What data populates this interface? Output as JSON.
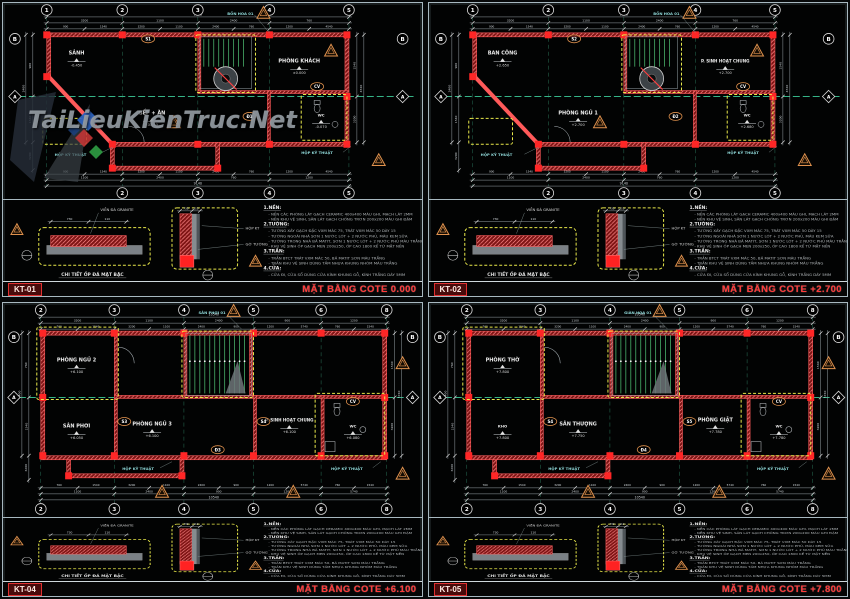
{
  "watermark": {
    "text": "TaiLieuKienTruc.Net"
  },
  "colors": {
    "frame_silver": "#a7b8c0",
    "wall_red_fill": "#7e1414",
    "wall_red_line": "#ff5a5a",
    "column_red": "#ff2626",
    "axis_green": "#35b487",
    "grid_green": "#2e7d62",
    "dim_gray": "#98a2a8",
    "dim_text": "#d5dbdf",
    "highlight_yellow": "#e8e84a",
    "warn_orange": "#e0924e",
    "tag_cyan": "#8fd8d8",
    "title_red": "#ff3a3a",
    "stair_green": "#49b06a",
    "watermark_gray": "#949ca3",
    "logo_dark": "#252c36",
    "logo_dark2": "#3a4147",
    "logo_blue": "#2f66c4",
    "logo_red": "#c23535",
    "logo_green": "#2f9e44",
    "logo_navy": "#1c3f7a"
  },
  "notes": {
    "groups": [
      {
        "head": "1.NỀN:",
        "lines": [
          "- NỀN CÁC PHÒNG LÁT GẠCH CERAMIC 400x400 MÀU GHI, MẠCH LÁT 2MM",
          "- NỀN KHU VỆ SINH, SÂN LÁT GẠCH CHỐNG TRƠN 200x200 MÀU GHI ĐẬM"
        ]
      },
      {
        "head": "2.TƯỜNG:",
        "lines": [
          "- TƯỜNG XÂY GẠCH ĐẶC VXM MÁC 75, TRÁT VXM MÁC 50 DÀY 15",
          "- TƯỜNG NGOÀI NHÀ SƠN 1 NƯỚC LÓT + 2 NƯỚC PHỦ, MÀU KEM SỮA",
          "- TƯỜNG TRONG NHÀ BẢ MATIT, SƠN 1 NƯỚC LÓT + 2 NƯỚC PHỦ MÀU TRẮNG",
          "- KHU VỆ SINH ỐP GẠCH MEN 200x250, ỐP CAO 1800 KỂ TỪ MẶT NỀN"
        ]
      },
      {
        "head": "3.TRẦN:",
        "lines": [
          "- TRẦN BTCT TRÁT VXM MÁC 50, BẢ MATIT SƠN MÀU TRẮNG",
          "- TRẦN KHU VỆ SINH DÙNG TẤM NHỰA KHUNG NHÔM MÀU TRẮNG"
        ]
      },
      {
        "head": "4.CỬA:",
        "lines": [
          "- CỬA ĐI, CỬA SỔ DÙNG CỬA KÍNH KHUNG GỖ, KÍNH TRẮNG DÀY 5MM"
        ]
      }
    ]
  },
  "details": {
    "left_caption": "CHI TIẾT ỐP ĐÁ MẶT BẬC",
    "labels": [
      "VIỀN ĐÁ GRANITE",
      "HỘP KT",
      "GỜ TƯỜNG"
    ],
    "dims": [
      "730",
      "110"
    ]
  },
  "sheets": [
    {
      "code": "KT-01",
      "title": "MẶT BẰNG COTE 0.000",
      "layout": "narrow",
      "grid_top": [
        "1",
        "2",
        "3",
        "4",
        "5"
      ],
      "grid_bottom": [
        "2",
        "3",
        "4",
        "5"
      ],
      "grid_left": [
        "B"
      ],
      "left_diamond": "A",
      "right_circle": "B",
      "right_diamond": "A",
      "rooms": [
        {
          "name": "PHÒNG KHÁCH",
          "elev": "±0.000"
        },
        {
          "name": "BẾP + ĂN",
          "elev": "-0.050"
        },
        {
          "name": "SẢNH",
          "elev": "-0.450"
        },
        {
          "name": "WC",
          "elev": "-0.070"
        }
      ],
      "tags": [
        "Đ1",
        "S1",
        "CV"
      ],
      "annos": [
        "BỒN HOA 01",
        "HỘP KỸ THUẬT",
        "HỘP KỸ THUẬT"
      ],
      "dims": [
        "900",
        "1540",
        "3200",
        "1100",
        "2400",
        "760",
        "1200",
        "4540"
      ],
      "dim_total": "9140"
    },
    {
      "code": "KT-02",
      "title": "MẶT BẰNG COTE +2.700",
      "layout": "narrow",
      "grid_top": [
        "1",
        "2",
        "3",
        "4",
        "5"
      ],
      "grid_bottom": [
        "2",
        "3",
        "4",
        "5"
      ],
      "grid_left": [
        "B"
      ],
      "left_diamond": "A",
      "right_circle": "B",
      "right_diamond": "A",
      "rooms": [
        {
          "name": "P. SINH HOẠT CHUNG",
          "elev": "+2.700"
        },
        {
          "name": "PHÒNG NGỦ 1",
          "elev": "+2.700"
        },
        {
          "name": "BAN CÔNG",
          "elev": "+2.650"
        },
        {
          "name": "WC",
          "elev": "+2.680"
        }
      ],
      "tags": [
        "Đ2",
        "S2",
        "CV"
      ],
      "annos": [
        "BỒN HOA 01",
        "HỘP KỸ THUẬT",
        "HỘP KỸ THUẬT"
      ],
      "dims": [
        "900",
        "1540",
        "3200",
        "1100",
        "2400",
        "760",
        "1200",
        "4540"
      ],
      "dim_total": "9140"
    },
    {
      "code": "KT-04",
      "title": "MẶT BẰNG COTE +6.100",
      "layout": "wide",
      "grid_top": [
        "2",
        "3",
        "4",
        "5",
        "6",
        "8"
      ],
      "grid_bottom": [
        "2",
        "3",
        "4",
        "5",
        "6",
        "8"
      ],
      "grid_left": [
        "B"
      ],
      "left_diamond": "A",
      "right_circle": "B",
      "right_diamond": "A",
      "rooms": [
        {
          "name": "PHÒNG NGỦ 2",
          "elev": "+6.100"
        },
        {
          "name": "PHÒNG NGỦ 3",
          "elev": "+6.100"
        },
        {
          "name": "P. SINH HOẠT CHUNG",
          "elev": "+6.100"
        },
        {
          "name": "WC",
          "elev": "+6.080"
        },
        {
          "name": "SÂN PHƠI",
          "elev": "+6.050"
        }
      ],
      "tags": [
        "Đ3",
        "S3",
        "CV",
        "S4"
      ],
      "annos": [
        "SÂN PHƠI 01",
        "HỘP KỸ THUẬT",
        "HỘP KỸ THUẬT"
      ],
      "dims": [
        "760",
        "1540",
        "3200",
        "1100",
        "2400",
        "900",
        "1200",
        "5740"
      ],
      "dim_total": "10540"
    },
    {
      "code": "KT-05",
      "title": "MẶT BẰNG COTE +7.800",
      "layout": "wide",
      "grid_top": [
        "2",
        "3",
        "4",
        "5",
        "6",
        "8"
      ],
      "grid_bottom": [
        "2",
        "3",
        "4",
        "5",
        "6",
        "8"
      ],
      "grid_left": [
        "B"
      ],
      "left_diamond": "A",
      "right_circle": "B",
      "right_diamond": "A",
      "rooms": [
        {
          "name": "PHÒNG THỜ",
          "elev": "+7.800"
        },
        {
          "name": "SÂN THƯỢNG",
          "elev": "+7.750"
        },
        {
          "name": "PHÒNG GIẶT",
          "elev": "+7.780"
        },
        {
          "name": "WC",
          "elev": "+7.780"
        },
        {
          "name": "KHO",
          "elev": "+7.800"
        }
      ],
      "tags": [
        "Đ4",
        "S4",
        "CV",
        "S5"
      ],
      "annos": [
        "GIÀN HOA 01",
        "HỘP KỸ THUẬT",
        "HỘP KỸ THUẬT"
      ],
      "dims": [
        "760",
        "1540",
        "3200",
        "1100",
        "2400",
        "900",
        "1200",
        "5740"
      ],
      "dim_total": "10540"
    }
  ]
}
